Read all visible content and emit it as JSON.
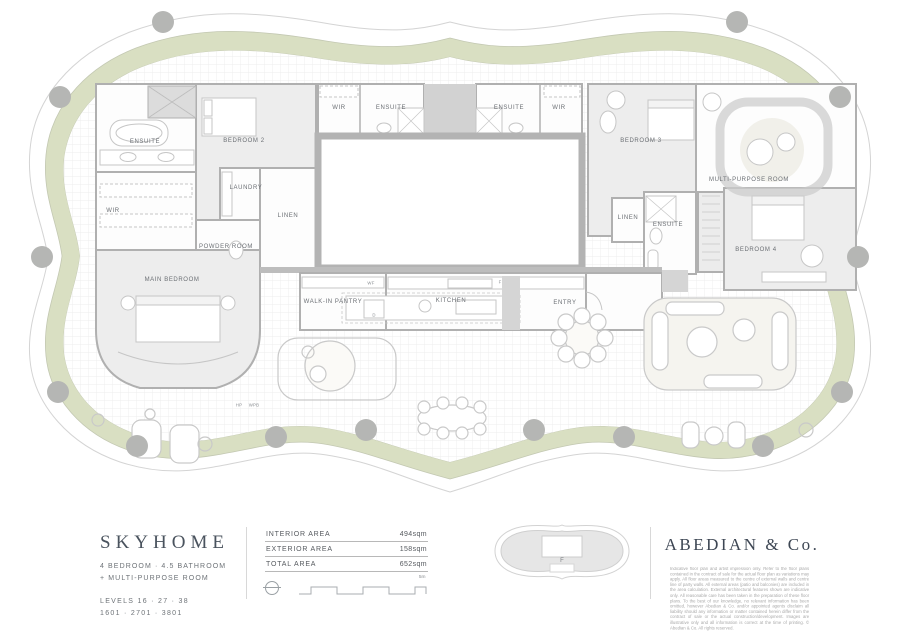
{
  "plan": {
    "labels": [
      {
        "text": "ENSUITE",
        "x": 145,
        "y": 142
      },
      {
        "text": "BEDROOM 2",
        "x": 244,
        "y": 141
      },
      {
        "text": "LAUNDRY",
        "x": 246,
        "y": 188
      },
      {
        "text": "WIR",
        "x": 113,
        "y": 211
      },
      {
        "text": "LINEN",
        "x": 288,
        "y": 216
      },
      {
        "text": "POWDER ROOM",
        "x": 226,
        "y": 247
      },
      {
        "text": "MAIN BEDROOM",
        "x": 172,
        "y": 280
      },
      {
        "text": "WIR",
        "x": 339,
        "y": 108
      },
      {
        "text": "ENSUITE",
        "x": 391,
        "y": 108
      },
      {
        "text": "ENSUITE",
        "x": 509,
        "y": 108
      },
      {
        "text": "WIR",
        "x": 559,
        "y": 108
      },
      {
        "text": "BEDROOM 3",
        "x": 641,
        "y": 141
      },
      {
        "text": "MULTI-PURPOSE ROOM",
        "x": 749,
        "y": 180
      },
      {
        "text": "LINEN",
        "x": 628,
        "y": 218
      },
      {
        "text": "ENSUITE",
        "x": 668,
        "y": 225
      },
      {
        "text": "BEDROOM 4",
        "x": 756,
        "y": 250
      },
      {
        "text": "WALK-IN PANTRY",
        "x": 333,
        "y": 302
      },
      {
        "text": "KITCHEN",
        "x": 451,
        "y": 301
      },
      {
        "text": "ENTRY",
        "x": 565,
        "y": 303
      },
      {
        "text": "WF",
        "x": 371,
        "y": 284,
        "s": 1
      },
      {
        "text": "D",
        "x": 374,
        "y": 316,
        "s": 1
      },
      {
        "text": "F",
        "x": 500,
        "y": 283,
        "s": 1
      },
      {
        "text": "HP",
        "x": 239,
        "y": 406,
        "s": 1
      },
      {
        "text": "WPB",
        "x": 254,
        "y": 406,
        "s": 1
      }
    ],
    "columns": [
      [
        163,
        22
      ],
      [
        737,
        22
      ],
      [
        60,
        97
      ],
      [
        840,
        97
      ],
      [
        42,
        257
      ],
      [
        858,
        257
      ],
      [
        58,
        392
      ],
      [
        842,
        392
      ],
      [
        137,
        446
      ],
      [
        763,
        446
      ],
      [
        276,
        437
      ],
      [
        366,
        430
      ],
      [
        534,
        430
      ],
      [
        624,
        437
      ]
    ],
    "colors": {
      "band": "#d9dfc2",
      "wall": "#b3b3b3",
      "room_fill": "#ededed",
      "column": "#b5b6b4"
    }
  },
  "info": {
    "name": "SKYHOME",
    "subtitle_line1": "4 BEDROOM · 4.5 BATHROOM",
    "subtitle_line2": "+ MULTI-PURPOSE ROOM",
    "levels": "LEVELS  16 · 27 · 38",
    "units": "1601 · 2701 · 3801",
    "areas": [
      {
        "label": "INTERIOR AREA",
        "value": "494sqm"
      },
      {
        "label": "EXTERIOR AREA",
        "value": "158sqm"
      },
      {
        "label": "TOTAL AREA",
        "value": "652sqm"
      }
    ],
    "scale_label": "5m",
    "keyplan_label": "F",
    "brand": "ABEDIAN & Co.",
    "disclaimer": "Indicative floor plan and artist impression only. Refer to the floor plans contained in the contract of sale for the actual floor plan as variations may apply. All floor areas measured to the centre of external walls and centre line of party walls. All external areas (patio and balconies) are included in the area calculation. External architectural features shown are indicative only. All reasonable care has been taken in the preparation of these floor plans. To the best of our knowledge, no relevant information has been omitted, however Abedian & Co. and/or appointed agents disclaim all liability should any information or matter contained herein differ from the contract of sale or the actual construction/development. Images are illustrative only and all information is correct at the time of printing. © Abedian & Co. All rights reserved."
  }
}
